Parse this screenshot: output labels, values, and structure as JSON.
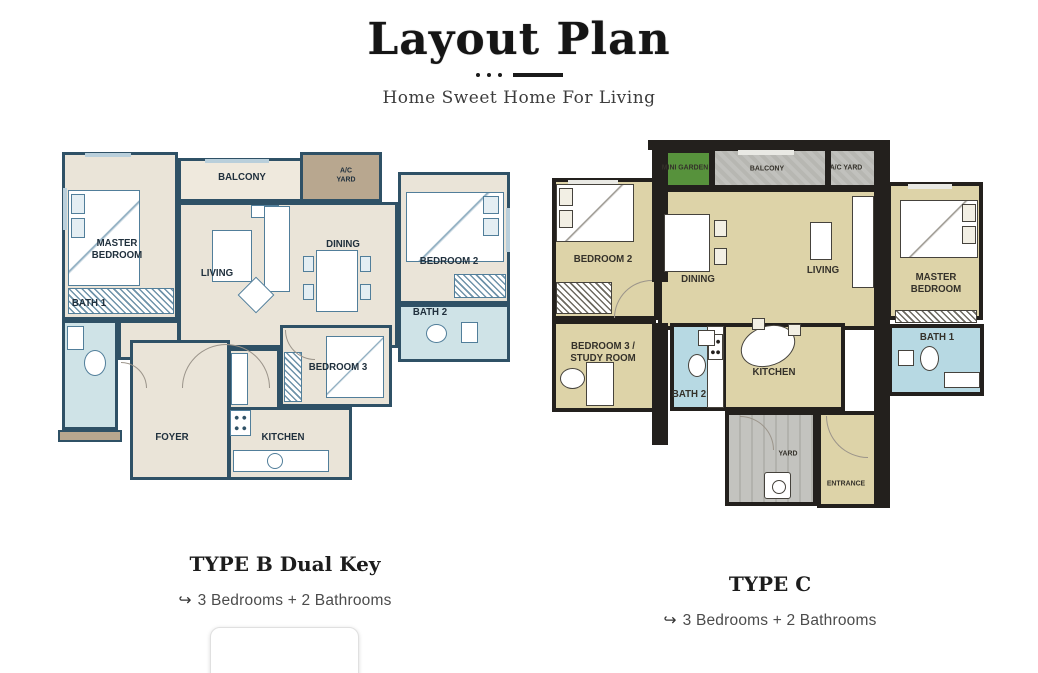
{
  "header": {
    "title": "Layout Plan",
    "subtitle": "Home Sweet Home For Living"
  },
  "plan_b": {
    "caption_title": "TYPE B Dual Key",
    "features_icon": "↪",
    "features": "3 Bedrooms + 2 Bathrooms",
    "rooms": {
      "master_bedroom": "MASTER BEDROOM",
      "balcony": "BALCONY",
      "ac_yard": "A/C YARD",
      "living": "LIVING",
      "dining": "DINING",
      "bedroom2": "BEDROOM 2",
      "bath1": "BATH 1",
      "bath2": "BATH 2",
      "bedroom3": "BEDROOM 3",
      "foyer": "FOYER",
      "kitchen": "KITCHEN"
    }
  },
  "plan_c": {
    "caption_title": "TYPE C",
    "features_icon": "↪",
    "features": "3 Bedrooms + 2 Bathrooms",
    "rooms": {
      "mini_garden": "MINI GARDEN",
      "balcony": "BALCONY",
      "ac_yard": "A/C YARD",
      "bedroom2": "BEDROOM 2",
      "dining": "DINING",
      "living": "LIVING",
      "master_bedroom": "MASTER BEDROOM",
      "bedroom3_study": "BEDROOM 3 / STUDY ROOM",
      "bath2": "BATH 2",
      "kitchen": "KITCHEN",
      "bath1": "BATH 1",
      "yard": "YARD",
      "entrance": "ENTRANCE"
    }
  },
  "colors": {
    "plan_b_wall": "#2f5166",
    "plan_b_floor": "#eae4d8",
    "plan_b_bath": "#cfe3e7",
    "plan_b_utility": "#b8a78f",
    "plan_c_wall": "#23201d",
    "plan_c_floor": "#ddd3a8",
    "plan_c_bath": "#b7d9e3",
    "plan_c_garden": "#57923c",
    "plan_c_concrete": "#bdbdb9"
  }
}
